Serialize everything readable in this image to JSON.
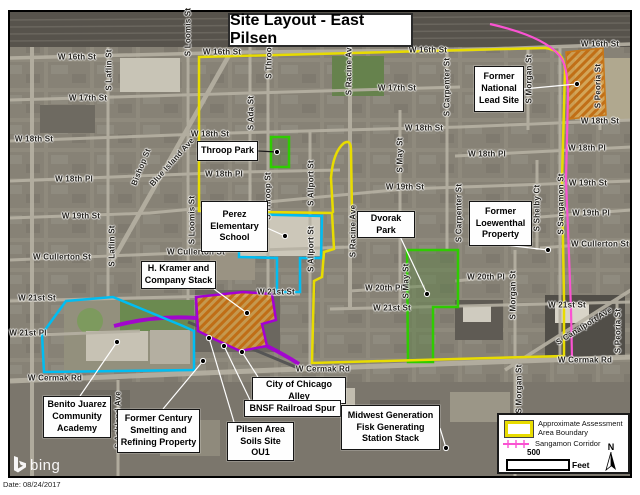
{
  "header": {
    "title": "Site Layout - East Pilsen"
  },
  "footer": {
    "date": "Date: 08/24/2017",
    "attribution": "bing"
  },
  "colors": {
    "boundary_yellow": "#e8dc00",
    "corridor_magenta": "#fa53d2",
    "site_cyan": "#00bdf2",
    "park_green": "#2ecc00",
    "spur_purple": "#a400d3",
    "hatch_orange": "#c06a10",
    "leader_white": "#ffffff",
    "leader_black": "#1a1a1a"
  },
  "legend": {
    "items": [
      {
        "label": "Approximate Assessment Area Boundary",
        "swatch": "yellow-boundary-swatch"
      },
      {
        "label": "Sangamon Corridor",
        "swatch": "magenta-line-swatch"
      }
    ],
    "scale_value": "500",
    "scale_unit": "Feet",
    "north": "N"
  },
  "map": {
    "streets": [
      {
        "text": "W 16th St",
        "x": 77,
        "y": 57
      },
      {
        "text": "W 16th St",
        "x": 222,
        "y": 52
      },
      {
        "text": "W 16th St",
        "x": 428,
        "y": 50
      },
      {
        "text": "W 16th St",
        "x": 600,
        "y": 44
      },
      {
        "text": "W 17th St",
        "x": 88,
        "y": 98
      },
      {
        "text": "W 17th St",
        "x": 397,
        "y": 88
      },
      {
        "text": "W 18th St",
        "x": 34,
        "y": 139
      },
      {
        "text": "W 18th St",
        "x": 210,
        "y": 134
      },
      {
        "text": "W 18th St",
        "x": 424,
        "y": 128
      },
      {
        "text": "W 18th St",
        "x": 600,
        "y": 121
      },
      {
        "text": "W 18th Pl",
        "x": 74,
        "y": 179
      },
      {
        "text": "W 18th Pl",
        "x": 224,
        "y": 174
      },
      {
        "text": "W 18th Pl",
        "x": 487,
        "y": 154
      },
      {
        "text": "W 18th Pl",
        "x": 587,
        "y": 148
      },
      {
        "text": "W 19th St",
        "x": 81,
        "y": 216
      },
      {
        "text": "W 19th St",
        "x": 405,
        "y": 187
      },
      {
        "text": "W 19th St",
        "x": 588,
        "y": 183
      },
      {
        "text": "W 19th Pl",
        "x": 591,
        "y": 213
      },
      {
        "text": "W Cullerton St",
        "x": 62,
        "y": 257
      },
      {
        "text": "W Cullerton St",
        "x": 196,
        "y": 252
      },
      {
        "text": "W Cullerton St",
        "x": 600,
        "y": 244
      },
      {
        "text": "W 20th Pl",
        "x": 384,
        "y": 288
      },
      {
        "text": "W 20th Pl",
        "x": 486,
        "y": 277
      },
      {
        "text": "W 21st St",
        "x": 37,
        "y": 298
      },
      {
        "text": "W 21st St",
        "x": 276,
        "y": 292
      },
      {
        "text": "W 21st St",
        "x": 392,
        "y": 308
      },
      {
        "text": "W 21st St",
        "x": 567,
        "y": 305
      },
      {
        "text": "W 21st Pl",
        "x": 28,
        "y": 333
      },
      {
        "text": "W Cermak Rd",
        "x": 55,
        "y": 378
      },
      {
        "text": "W Cermak Rd",
        "x": 323,
        "y": 369
      },
      {
        "text": "W Cermak Rd",
        "x": 585,
        "y": 360
      },
      {
        "text": "S Laflin St",
        "x": 109,
        "y": 70,
        "rot": -90
      },
      {
        "text": "S Laflin St",
        "x": 112,
        "y": 246,
        "rot": -90
      },
      {
        "text": "S Loomis St",
        "x": 188,
        "y": 32,
        "rot": -90
      },
      {
        "text": "S Loomis St",
        "x": 192,
        "y": 220,
        "rot": -90
      },
      {
        "text": "S Ashland Ave",
        "x": 118,
        "y": 420,
        "rot": -90
      },
      {
        "text": "S Throop St",
        "x": 269,
        "y": 55,
        "rot": -90
      },
      {
        "text": "S Throop St",
        "x": 268,
        "y": 196,
        "rot": -90
      },
      {
        "text": "S Ada St",
        "x": 251,
        "y": 113,
        "rot": -90
      },
      {
        "text": "S Allport St",
        "x": 311,
        "y": 183,
        "rot": -90
      },
      {
        "text": "S Allport St",
        "x": 311,
        "y": 249,
        "rot": -90
      },
      {
        "text": "S Racine Ave",
        "x": 349,
        "y": 69,
        "rot": -90
      },
      {
        "text": "S Racine Ave",
        "x": 353,
        "y": 231,
        "rot": -90
      },
      {
        "text": "S May St",
        "x": 400,
        "y": 155,
        "rot": -90
      },
      {
        "text": "S May St",
        "x": 406,
        "y": 281,
        "rot": -90
      },
      {
        "text": "S Carpenter St",
        "x": 447,
        "y": 87,
        "rot": -90
      },
      {
        "text": "S Carpenter St",
        "x": 459,
        "y": 213,
        "rot": -90
      },
      {
        "text": "S Morgan St",
        "x": 529,
        "y": 79,
        "rot": -90
      },
      {
        "text": "S Morgan St",
        "x": 513,
        "y": 295,
        "rot": -90
      },
      {
        "text": "S Morgan St",
        "x": 519,
        "y": 389,
        "rot": -90
      },
      {
        "text": "S Peoria St",
        "x": 598,
        "y": 86,
        "rot": -90
      },
      {
        "text": "S Peoria St",
        "x": 618,
        "y": 331,
        "rot": -90
      },
      {
        "text": "S Sangamon St",
        "x": 561,
        "y": 204,
        "rot": -90
      },
      {
        "text": "S Shelby Ct",
        "x": 537,
        "y": 208,
        "rot": -90
      },
      {
        "text": "Bishop St",
        "x": 141,
        "y": 167,
        "rot": -68
      },
      {
        "text": "Blue Island Ave",
        "x": 172,
        "y": 162,
        "rot": -48
      },
      {
        "text": "S Canalport Ave",
        "x": 584,
        "y": 326,
        "rot": -32
      }
    ],
    "callouts": [
      {
        "id": "callout-throop-park",
        "lines": [
          "Throop Park"
        ],
        "x": 197,
        "y": 141,
        "w": 61,
        "h": 20,
        "leader": {
          "x1": 258,
          "y1": 151,
          "x2": 277,
          "y2": 152,
          "color": "#1a1a1a"
        }
      },
      {
        "id": "callout-former-national-lead-site",
        "lines": [
          "Former",
          "National",
          "Lead Site"
        ],
        "x": 474,
        "y": 66,
        "w": 50,
        "h": 46,
        "leader": {
          "x1": 523,
          "y1": 89,
          "x2": 577,
          "y2": 84,
          "color": "#ffffff"
        }
      },
      {
        "id": "callout-perez-elementary-school",
        "lines": [
          "Perez",
          "Elementary",
          "School"
        ],
        "x": 201,
        "y": 201,
        "w": 67,
        "h": 51,
        "leader": {
          "x1": 267,
          "y1": 228,
          "x2": 285,
          "y2": 236,
          "color": "#ffffff"
        }
      },
      {
        "id": "callout-dvorak-park",
        "lines": [
          "Dvorak Park"
        ],
        "x": 357,
        "y": 211,
        "w": 58,
        "h": 21,
        "leader": {
          "x1": 398,
          "y1": 232,
          "x2": 427,
          "y2": 294,
          "color": "#ffffff"
        }
      },
      {
        "id": "callout-former-loewenthal-property",
        "lines": [
          "Former",
          "Loewenthal",
          "Property"
        ],
        "x": 469,
        "y": 201,
        "w": 63,
        "h": 45,
        "leader": {
          "x1": 505,
          "y1": 245,
          "x2": 548,
          "y2": 250,
          "color": "#ffffff"
        }
      },
      {
        "id": "callout-h-kramer-company-stack",
        "lines": [
          "H. Kramer and",
          "Company Stack"
        ],
        "x": 141,
        "y": 261,
        "w": 75,
        "h": 28,
        "leader": {
          "x1": 214,
          "y1": 289,
          "x2": 247,
          "y2": 313,
          "color": "#ffffff"
        }
      },
      {
        "id": "callout-benito-juarez-academy",
        "lines": [
          "Benito Juarez",
          "Community",
          "Academy"
        ],
        "x": 43,
        "y": 396,
        "w": 68,
        "h": 42,
        "leader": {
          "x1": 80,
          "y1": 396,
          "x2": 117,
          "y2": 342,
          "color": "#ffffff"
        }
      },
      {
        "id": "callout-former-century-smelting",
        "lines": [
          "Former Century",
          "Smelting and",
          "Refining Property"
        ],
        "x": 117,
        "y": 409,
        "w": 83,
        "h": 44,
        "leader": {
          "x1": 163,
          "y1": 409,
          "x2": 203,
          "y2": 361,
          "color": "#ffffff"
        }
      },
      {
        "id": "callout-city-of-chicago-alley",
        "lines": [
          "City of Chicago Alley"
        ],
        "x": 252,
        "y": 377,
        "w": 94,
        "h": 17,
        "leader": {
          "x1": 258,
          "y1": 377,
          "x2": 242,
          "y2": 352,
          "color": "#ffffff"
        }
      },
      {
        "id": "callout-bnsf-railroad-spur",
        "lines": [
          "BNSF Railroad Spur"
        ],
        "x": 244,
        "y": 400,
        "w": 97,
        "h": 17,
        "leader": {
          "x1": 250,
          "y1": 400,
          "x2": 224,
          "y2": 346,
          "color": "#ffffff"
        }
      },
      {
        "id": "callout-pilsen-area-soils-ou1",
        "lines": [
          "Pilsen Area",
          "Soils Site OU1"
        ],
        "x": 227,
        "y": 422,
        "w": 67,
        "h": 28,
        "leader": {
          "x1": 234,
          "y1": 422,
          "x2": 209,
          "y2": 338,
          "color": "#ffffff"
        }
      },
      {
        "id": "callout-midwest-generation-fisk",
        "lines": [
          "Midwest Generation",
          "Fisk Generating",
          "Station Stack"
        ],
        "x": 341,
        "y": 405,
        "w": 99,
        "h": 45,
        "leader": {
          "x1": 440,
          "y1": 428,
          "x2": 446,
          "y2": 448,
          "color": "#ffffff"
        }
      }
    ]
  }
}
